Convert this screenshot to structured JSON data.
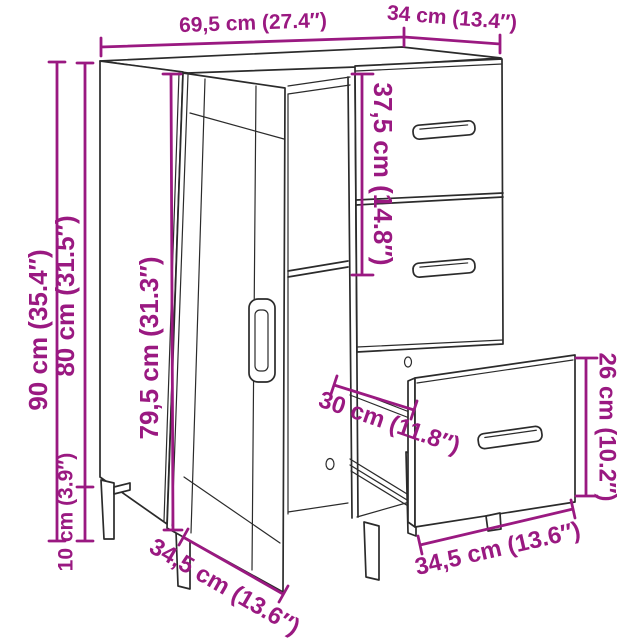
{
  "diagram": {
    "kind": "product-dimension-diagram",
    "product": "sideboard with door, open shelf and 3 drawers (bottom drawer shown pulled out)",
    "background_color": "#ffffff",
    "outline_color": "#2b2b2b",
    "dimension_color": "#9a1981",
    "dimensions": {
      "top_width": {
        "label": "69,5 cm (27.4″)",
        "cm": "69,5",
        "in": "27.4"
      },
      "top_depth": {
        "label": "34 cm (13.4″)",
        "cm": "34",
        "in": "13.4"
      },
      "total_height": {
        "label": "90 cm (35.4″)",
        "cm": "90",
        "in": "35.4"
      },
      "body_height": {
        "label": "80 cm (31.5″)",
        "cm": "80",
        "in": "31.5"
      },
      "door_height": {
        "label": "79,5 cm (31.3″)",
        "cm": "79,5",
        "in": "31.3"
      },
      "drawer_section_height": {
        "label": "37,5 cm (14.8″)",
        "cm": "37,5",
        "in": "14.8"
      },
      "drawer_front_height": {
        "label": "26 cm (10.2″)",
        "cm": "26",
        "in": "10.2"
      },
      "drawer_extension_depth": {
        "label": "30 cm (11.8″)",
        "cm": "30",
        "in": "11.8"
      },
      "leg_height": {
        "label": "10 cm (3.9″)",
        "cm": "10",
        "in": "3.9"
      },
      "door_section_width": {
        "label": "34,5 cm (13.6″)",
        "cm": "34,5",
        "in": "13.6"
      },
      "drawer_width": {
        "label": "34,5 cm (13.6″)",
        "cm": "34,5",
        "in": "13.6"
      }
    }
  }
}
